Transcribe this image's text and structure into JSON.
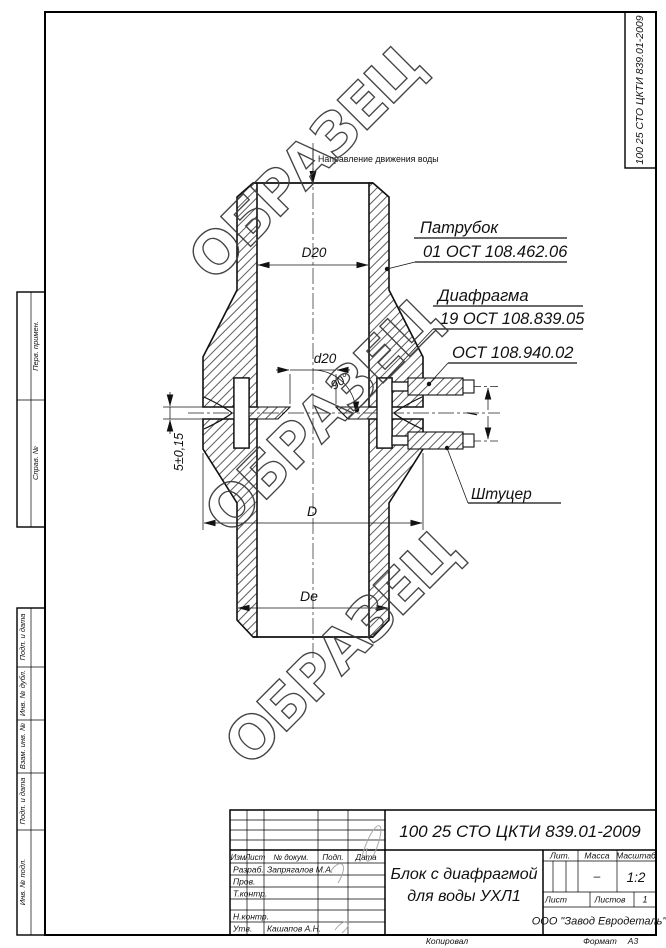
{
  "corner_stamp": {
    "text": "100 25 СТО ЦКТИ 839.01-2009"
  },
  "watermark": {
    "text": "ОБРАЗЕЦ"
  },
  "margin_fields": {
    "top": [
      "Перв. примен.",
      "Справ. №"
    ],
    "bottom": [
      "Подп. и дата",
      "Инв. № дубл.",
      "Взам. инв. №",
      "Подп. и дата",
      "Инв. № подл."
    ]
  },
  "drawing": {
    "flow_note": "Направление движения воды",
    "callouts": {
      "patrubok_title": "Патрубок",
      "patrubok_doc": "01 ОСТ 108.462.06",
      "diafragma_title": "Диафрагма",
      "diafragma_doc": "19 ОСТ 108.839.05",
      "ost_doc": "ОСТ 108.940.02",
      "shtutser": "Штуцер"
    },
    "dimensions": {
      "top_diameter": "D20",
      "orifice_diameter": "d20",
      "cone_angle": "90°",
      "thickness": "5±0,15",
      "body_diameter": "D",
      "outlet_diameter": "De",
      "fitting_spacing": "l"
    }
  },
  "title_block": {
    "doc_number": "100 25 СТО ЦКТИ 839.01-2009",
    "columns": [
      "Изм",
      "Лист",
      "№ докум.",
      "Подп.",
      "Дата"
    ],
    "rows": [
      {
        "label": "Разраб.",
        "value": "Запрягалов М.А."
      },
      {
        "label": "Пров.",
        "value": ""
      },
      {
        "label": "Т.контр.",
        "value": ""
      },
      {
        "label": "Н.контр.",
        "value": ""
      },
      {
        "label": "Утв.",
        "value": "Кашапов А.Н."
      }
    ],
    "title_line1": "Блок с диафрагмой",
    "title_line2": "для воды УХЛ1",
    "lit_label": "Лит.",
    "mass_label": "Масса",
    "mass_value": "–",
    "scale_label": "Масштаб",
    "scale_value": "1:2",
    "sheet_label": "Лист",
    "sheets_label": "Листов",
    "sheets_value": "1",
    "company": "ООО \"Завод Евродеталь\"",
    "footer_copied": "Копировал",
    "footer_format_label": "Формат",
    "footer_format_value": "А3"
  }
}
